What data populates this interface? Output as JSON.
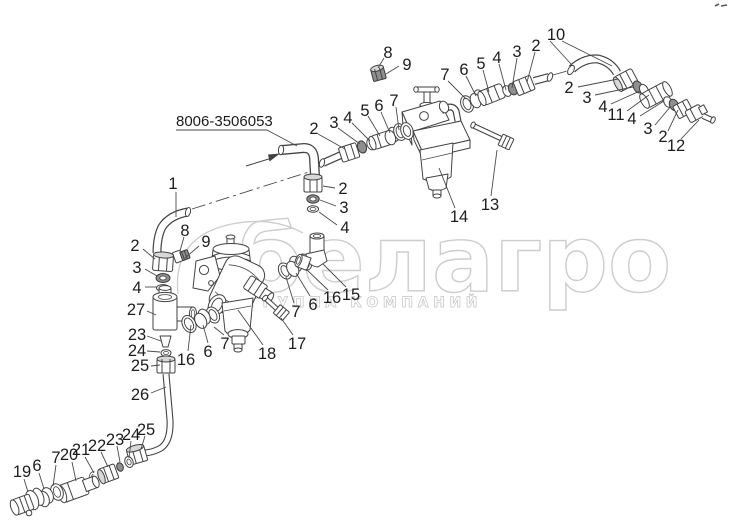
{
  "diagram": {
    "title_label": "8006-3506053",
    "watermark": {
      "logo_text": "белагро",
      "subtitle": "ГРУППА КОМПАНИЙ"
    },
    "colors": {
      "line": "#424242",
      "watermark": "#cdcdcd",
      "background": "#ffffff"
    },
    "callouts": [
      {
        "n": "1",
        "x": 173,
        "y": 183,
        "l": [
          [
            176,
            192,
            176,
            217
          ]
        ]
      },
      {
        "n": "2",
        "x": 135,
        "y": 245,
        "l": [
          [
            143,
            249,
            155,
            259
          ]
        ]
      },
      {
        "n": "3",
        "x": 137,
        "y": 267,
        "l": [
          [
            145,
            269,
            157,
            276
          ]
        ]
      },
      {
        "n": "4",
        "x": 137,
        "y": 287,
        "l": [
          [
            145,
            287,
            157,
            287
          ]
        ]
      },
      {
        "n": "8",
        "x": 185,
        "y": 230,
        "l": [
          [
            184,
            237,
            180,
            251
          ]
        ]
      },
      {
        "n": "9",
        "x": 206,
        "y": 241,
        "l": [
          [
            199,
            246,
            185,
            258
          ]
        ]
      },
      {
        "n": "27",
        "x": 136,
        "y": 309,
        "l": [
          [
            147,
            311,
            156,
            315
          ]
        ]
      },
      {
        "n": "23",
        "x": 137,
        "y": 334,
        "l": [
          [
            147,
            336,
            161,
            341
          ]
        ]
      },
      {
        "n": "24",
        "x": 137,
        "y": 350,
        "l": [
          [
            147,
            351,
            160,
            352
          ]
        ]
      },
      {
        "n": "25",
        "x": 140,
        "y": 365,
        "l": [
          [
            151,
            366,
            160,
            365
          ]
        ]
      },
      {
        "n": "26",
        "x": 140,
        "y": 394,
        "l": [
          [
            151,
            393,
            166,
            387
          ]
        ]
      },
      {
        "n": "19",
        "x": 22,
        "y": 471,
        "l": [
          [
            24,
            479,
            28,
            492
          ]
        ]
      },
      {
        "n": "6",
        "x": 37,
        "y": 465,
        "l": [
          [
            39,
            473,
            44,
            489
          ]
        ]
      },
      {
        "n": "7",
        "x": 56,
        "y": 457,
        "l": [
          [
            56,
            465,
            53,
            486
          ]
        ]
      },
      {
        "n": "20",
        "x": 69,
        "y": 454,
        "l": [
          [
            72,
            462,
            76,
            481
          ]
        ]
      },
      {
        "n": "21",
        "x": 81,
        "y": 449,
        "l": [
          [
            85,
            457,
            94,
            473
          ]
        ]
      },
      {
        "n": "22",
        "x": 97,
        "y": 445,
        "l": [
          [
            101,
            452,
            108,
            467
          ]
        ]
      },
      {
        "n": "23",
        "x": 115,
        "y": 439,
        "l": [
          [
            117,
            446,
            120,
            462
          ]
        ]
      },
      {
        "n": "24",
        "x": 131,
        "y": 434,
        "l": [
          [
            131,
            441,
            129,
            458
          ]
        ]
      },
      {
        "n": "25",
        "x": 146,
        "y": 429,
        "l": [
          [
            145,
            436,
            141,
            449
          ]
        ]
      },
      {
        "n": "16",
        "x": 186,
        "y": 359,
        "l": [
          [
            188,
            351,
            191,
            325
          ]
        ]
      },
      {
        "n": "6",
        "x": 208,
        "y": 351,
        "l": [
          [
            208,
            343,
            203,
            325
          ]
        ]
      },
      {
        "n": "7",
        "x": 225,
        "y": 343,
        "l": [
          [
            224,
            335,
            214,
            327
          ]
        ]
      },
      {
        "n": "18",
        "x": 267,
        "y": 353,
        "l": [
          [
            263,
            345,
            238,
            310
          ]
        ]
      },
      {
        "n": "17",
        "x": 297,
        "y": 343,
        "l": [
          [
            293,
            335,
            281,
            318
          ]
        ]
      },
      {
        "n": "7",
        "x": 296,
        "y": 311,
        "l": [
          [
            294,
            303,
            286,
            277
          ]
        ]
      },
      {
        "n": "6",
        "x": 313,
        "y": 304,
        "l": [
          [
            310,
            296,
            296,
            273
          ]
        ]
      },
      {
        "n": "16",
        "x": 332,
        "y": 297,
        "l": [
          [
            328,
            290,
            306,
            269
          ]
        ]
      },
      {
        "n": "15",
        "x": 351,
        "y": 294,
        "l": [
          [
            346,
            287,
            323,
            264
          ]
        ]
      },
      {
        "n": "2",
        "x": 343,
        "y": 188,
        "l": [
          [
            335,
            188,
            323,
            186
          ]
        ]
      },
      {
        "n": "3",
        "x": 344,
        "y": 207,
        "l": [
          [
            336,
            206,
            320,
            200
          ]
        ]
      },
      {
        "n": "4",
        "x": 345,
        "y": 227,
        "l": [
          [
            337,
            225,
            319,
            212
          ]
        ]
      },
      {
        "n": "8",
        "x": 388,
        "y": 52,
        "l": [
          [
            384,
            58,
            378,
            68
          ]
        ]
      },
      {
        "n": "9",
        "x": 407,
        "y": 64,
        "l": [
          [
            399,
            66,
            386,
            74
          ]
        ]
      },
      {
        "n": "2",
        "x": 314,
        "y": 128,
        "l": [
          [
            318,
            134,
            345,
            149
          ]
        ]
      },
      {
        "n": "3",
        "x": 334,
        "y": 122,
        "l": [
          [
            338,
            128,
            360,
            144
          ]
        ]
      },
      {
        "n": "4",
        "x": 348,
        "y": 117,
        "l": [
          [
            352,
            123,
            370,
            141
          ]
        ]
      },
      {
        "n": "5",
        "x": 365,
        "y": 110,
        "l": [
          [
            368,
            116,
            380,
            136
          ]
        ]
      },
      {
        "n": "6",
        "x": 379,
        "y": 105,
        "l": [
          [
            381,
            112,
            390,
            133
          ]
        ]
      },
      {
        "n": "7",
        "x": 394,
        "y": 100,
        "l": [
          [
            396,
            107,
            399,
            130
          ]
        ]
      },
      {
        "n": "7",
        "x": 445,
        "y": 74,
        "l": [
          [
            448,
            81,
            466,
            99
          ]
        ]
      },
      {
        "n": "6",
        "x": 464,
        "y": 69,
        "l": [
          [
            466,
            76,
            476,
            96
          ]
        ]
      },
      {
        "n": "5",
        "x": 481,
        "y": 63,
        "l": [
          [
            483,
            70,
            489,
            92
          ]
        ]
      },
      {
        "n": "4",
        "x": 497,
        "y": 57,
        "l": [
          [
            499,
            64,
            506,
            90
          ]
        ]
      },
      {
        "n": "3",
        "x": 517,
        "y": 51,
        "l": [
          [
            517,
            58,
            512,
            88
          ]
        ]
      },
      {
        "n": "2",
        "x": 536,
        "y": 45,
        "l": [
          [
            535,
            52,
            527,
            82
          ]
        ]
      },
      {
        "n": "13",
        "x": 490,
        "y": 204,
        "l": [
          [
            491,
            196,
            497,
            150
          ]
        ]
      },
      {
        "n": "14",
        "x": 459,
        "y": 216,
        "l": [
          [
            455,
            208,
            439,
            168
          ]
        ]
      },
      {
        "n": "10",
        "x": 556,
        "y": 34,
        "l": [
          [
            550,
            41,
            571,
            64
          ],
          [
            562,
            41,
            612,
            66
          ]
        ]
      },
      {
        "n": "2",
        "x": 569,
        "y": 87,
        "l": [
          [
            578,
            87,
            618,
            79
          ]
        ]
      },
      {
        "n": "3",
        "x": 587,
        "y": 97,
        "l": [
          [
            595,
            95,
            633,
            87
          ]
        ]
      },
      {
        "n": "4",
        "x": 603,
        "y": 106,
        "l": [
          [
            611,
            104,
            640,
            91
          ]
        ]
      },
      {
        "n": "11",
        "x": 616,
        "y": 114,
        "l": [
          [
            627,
            111,
            649,
            95
          ]
        ]
      },
      {
        "n": "4",
        "x": 632,
        "y": 118,
        "l": [
          [
            640,
            116,
            664,
            101
          ]
        ]
      },
      {
        "n": "3",
        "x": 648,
        "y": 128,
        "l": [
          [
            655,
            125,
            671,
            106
          ]
        ]
      },
      {
        "n": "2",
        "x": 663,
        "y": 136,
        "l": [
          [
            668,
            131,
            678,
            110
          ]
        ]
      },
      {
        "n": "12",
        "x": 676,
        "y": 145,
        "l": [
          [
            681,
            139,
            699,
            120
          ]
        ]
      }
    ]
  }
}
